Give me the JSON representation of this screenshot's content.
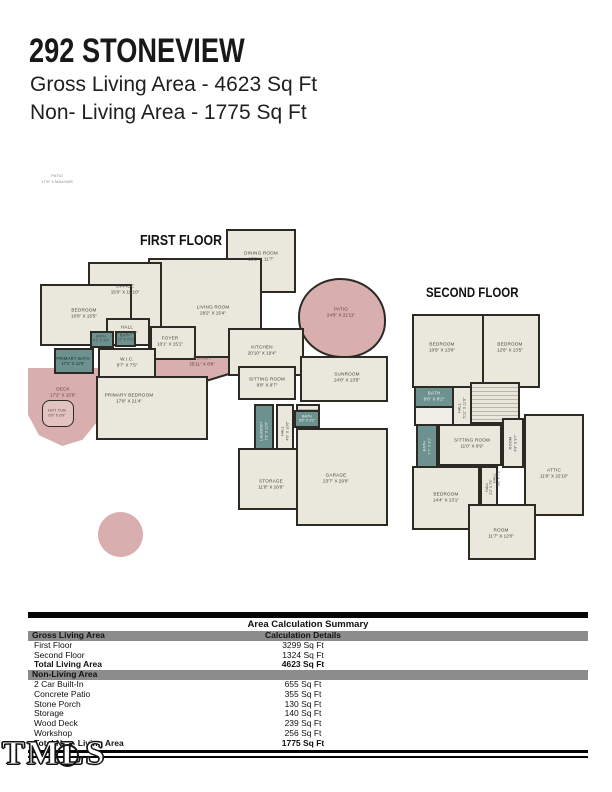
{
  "header": {
    "title": "292 STONEVIEW",
    "gross_line": "Gross Living Area - 4623 Sq Ft",
    "nonliving_line": "Non- Living Area - 1775 Sq Ft"
  },
  "site_note": {
    "name": "PATIO",
    "dims": "17'6\" X MAX/VAR"
  },
  "first_floor": {
    "heading": "FIRST FLOOR",
    "rooms": [
      {
        "name": "DINING ROOM",
        "dims": "13'2\" X 11'7\""
      },
      {
        "name": "OFFICE",
        "dims": "15'0\" X 15'10\""
      },
      {
        "name": "BEDROOM",
        "dims": "10'9\" X 15'5\""
      },
      {
        "name": "LIVING ROOM",
        "dims": "29'2\" X 15'4\""
      },
      {
        "name": "HALL",
        "dims": "7'2\" X 3'8\""
      },
      {
        "name": "FOYER",
        "dims": "10'1\" X 15'1\""
      },
      {
        "name": "BATH",
        "dims": "5'1\" X 3'8\""
      },
      {
        "name": "BATH",
        "dims": "4'11\" X 2'10\""
      },
      {
        "name": "PRIMARY BATH",
        "dims": "17'4\" X 11'9\""
      },
      {
        "name": "W.I.C.",
        "dims": "9'7\" X 7'5\""
      },
      {
        "name": "DECK",
        "dims": "17'2\" X 15'9\""
      },
      {
        "name": "HOT TUB",
        "dims": "6'9\" X 6'9\""
      },
      {
        "name": "PRIMARY BEDROOM",
        "dims": "17'8\" X 21'4\""
      },
      {
        "name": "PORCH",
        "dims": "25'11\" X 8'8\""
      },
      {
        "name": "KITCHEN",
        "dims": "20'10\" X 19'4\""
      },
      {
        "name": "PATIO",
        "dims": "24'8\" X 21'11\""
      },
      {
        "name": "SITTING ROOM",
        "dims": "9'8\" X 9'7\""
      },
      {
        "name": "SUNROOM",
        "dims": "24'0\" X 13'5\""
      },
      {
        "name": "LAUNDRY",
        "dims": "7'3\" X 11'6\""
      },
      {
        "name": "HALL",
        "dims": "4'0\" X 10'6\""
      },
      {
        "name": "BATH",
        "dims": "5'6\" X 3'2\""
      },
      {
        "name": "STORAGE",
        "dims": "11'8\" X 16'8\""
      },
      {
        "name": "GARAGE",
        "dims": "23'7\" X 29'0\""
      }
    ]
  },
  "second_floor": {
    "heading": "SECOND FLOOR",
    "rooms": [
      {
        "name": "BEDROOM",
        "dims": "10'9\" X 13'0\""
      },
      {
        "name": "BEDROOM",
        "dims": "12'6\" X 13'5\""
      },
      {
        "name": "BATH",
        "dims": "8'0\" X 8'2\""
      },
      {
        "name": "HALL",
        "dims": "5'11\" X 11'9\""
      },
      {
        "name": "BATH",
        "dims": "7'7\" X 9'1\""
      },
      {
        "name": "SITTING ROOM",
        "dims": "11'0\" X 9'9\""
      },
      {
        "name": "ROOM",
        "dims": "4'9\" X 9'7\""
      },
      {
        "name": "HALL",
        "dims": "3'8\" X 7'2\""
      },
      {
        "name": "ATTIC",
        "dims": "11'8\" X 22'10\""
      },
      {
        "name": "BEDROOM",
        "dims": "14'4\" X 13'1\""
      },
      {
        "name": "HALL",
        "dims": "2'2\" X 7'2\""
      },
      {
        "name": "ROOM",
        "dims": "11'7\" X 12'0\""
      }
    ]
  },
  "watermark": "TMLS",
  "summary_table": {
    "title": "Area Calculation Summary",
    "gross_header": "Gross Living Area",
    "details_header": "Calculation Details",
    "gross_rows": [
      {
        "label": "First Floor",
        "value": "3299 Sq Ft"
      },
      {
        "label": "Second Floor",
        "value": "1324 Sq Ft"
      }
    ],
    "total_living": {
      "label": "Total Living Area",
      "value": "4623 Sq Ft"
    },
    "nonliving_header": "Non-Living Area",
    "nonliving_rows": [
      {
        "label": "2 Car Built-In",
        "value": "655 Sq Ft"
      },
      {
        "label": "Concrete Patio",
        "value": "355 Sq Ft"
      },
      {
        "label": "Stone Porch",
        "value": "130 Sq Ft"
      },
      {
        "label": "Storage",
        "value": "140 Sq Ft"
      },
      {
        "label": "Wood Deck",
        "value": "239 Sq Ft"
      },
      {
        "label": "Workshop",
        "value": "256 Sq Ft"
      }
    ],
    "total_nonliving": {
      "label": "Total Non- Living Area",
      "value": "1775 Sq Ft"
    }
  },
  "colors": {
    "room_fill": "#eae8dc",
    "outdoor_pink": "#d9aeae",
    "bath_teal": "#6d918e",
    "wall": "#2b2a24",
    "table_bar": "#8c8c8c"
  }
}
